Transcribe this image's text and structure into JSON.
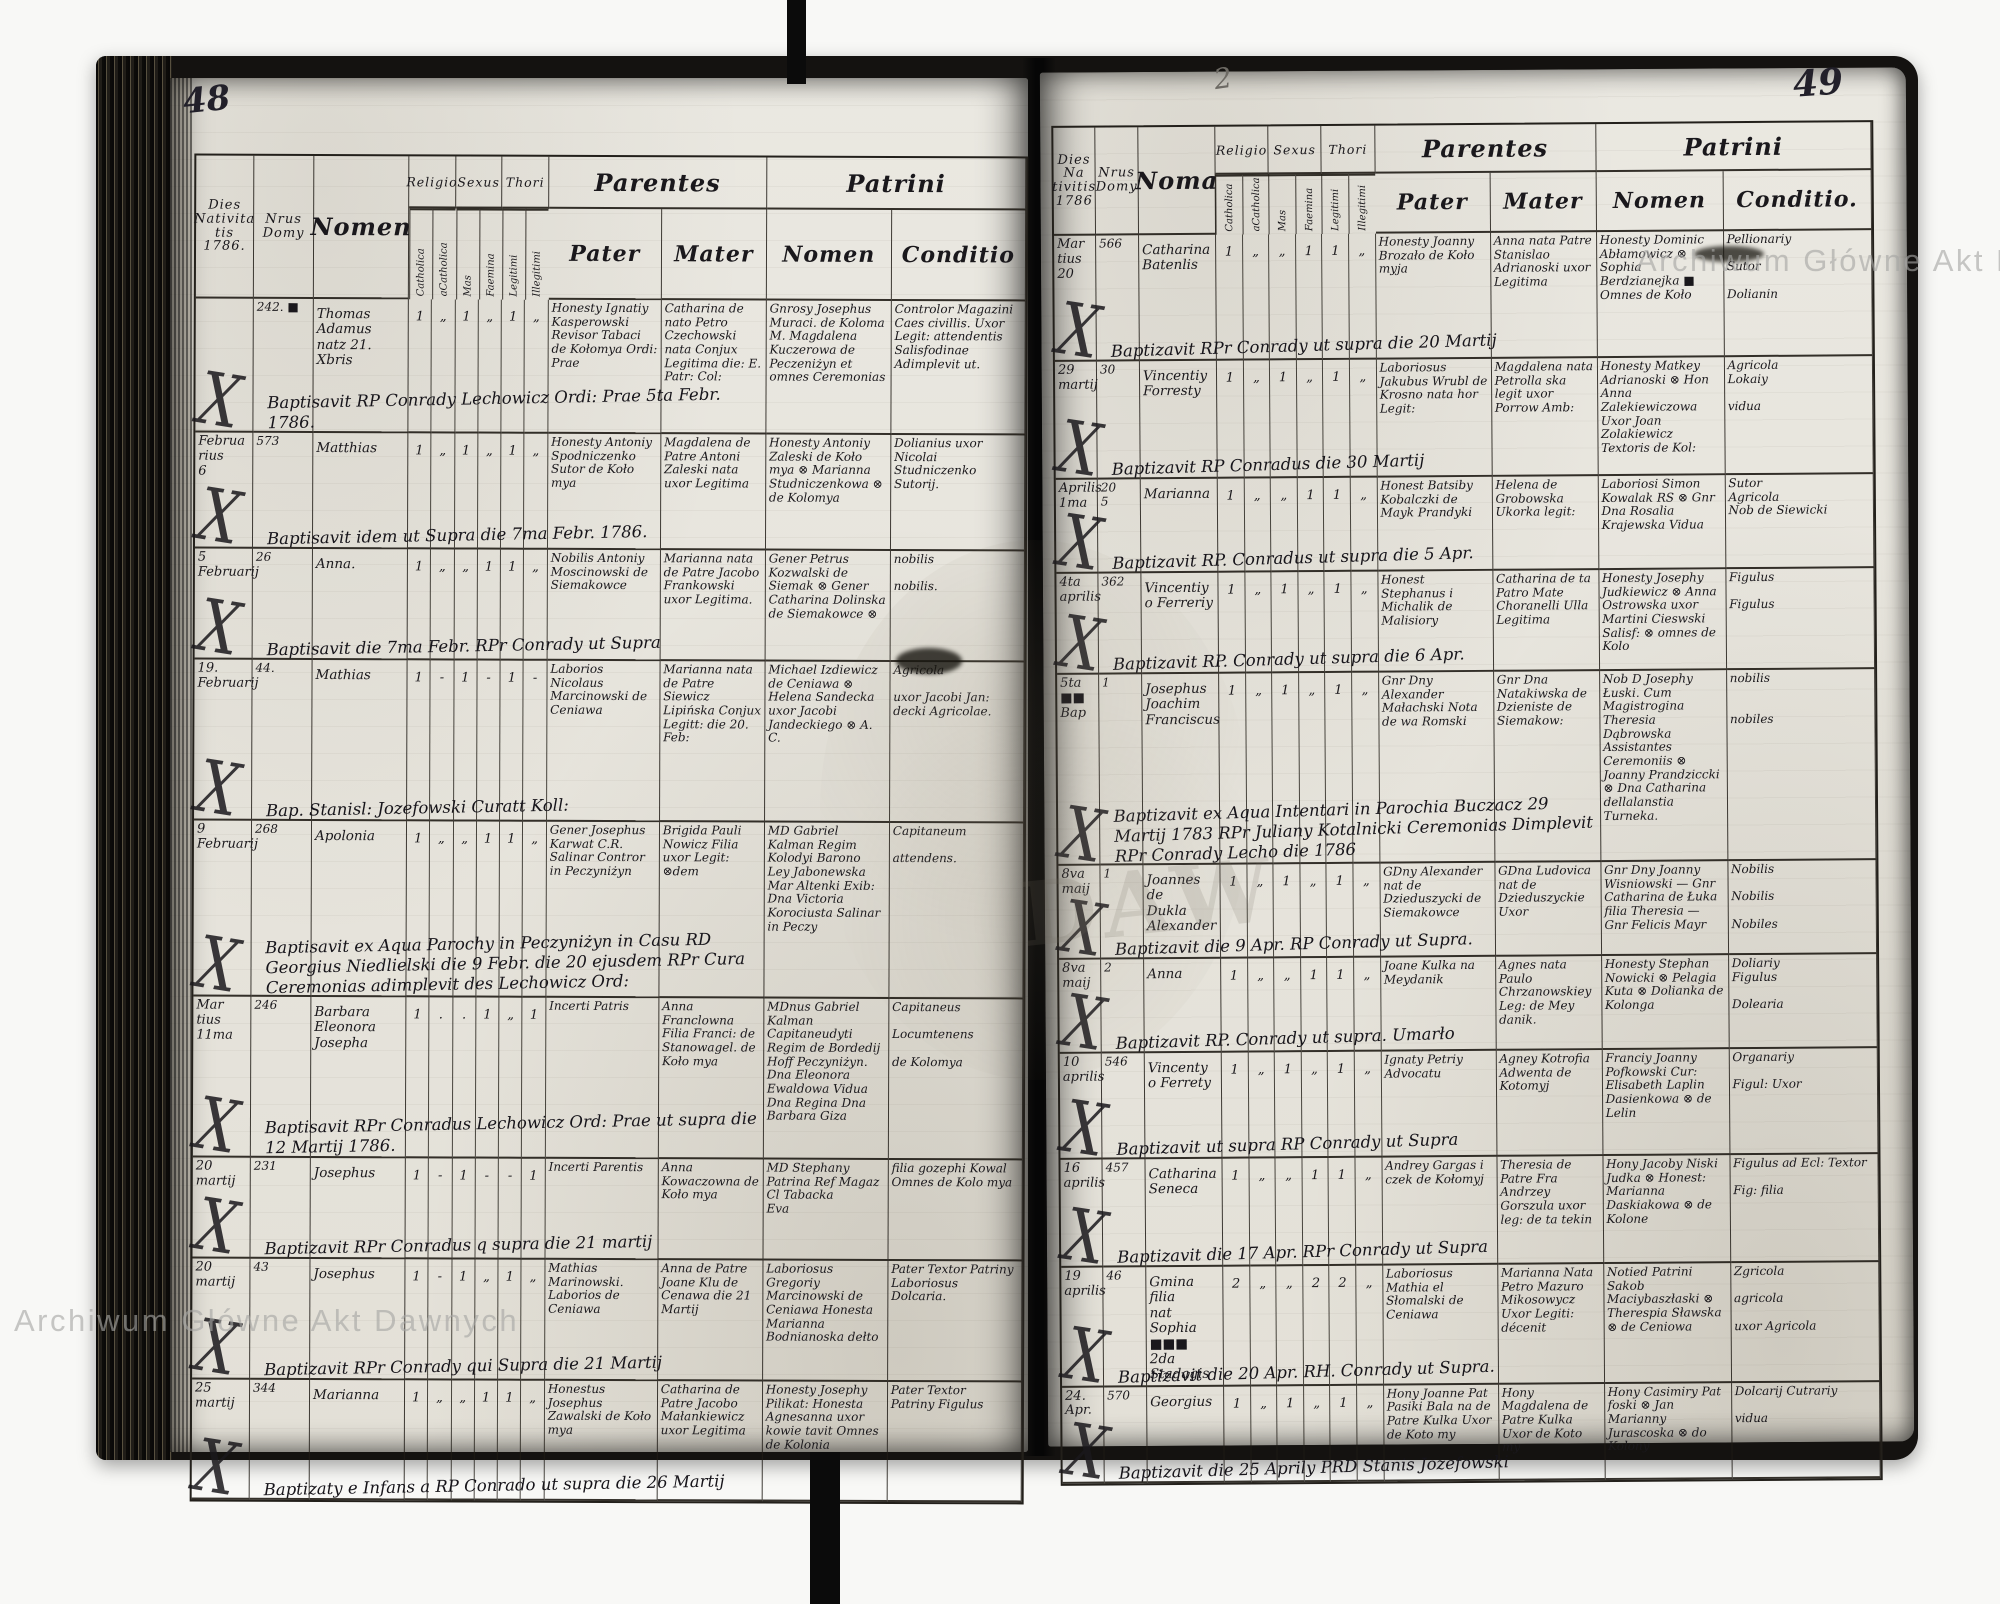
{
  "scan": {
    "page_left_number": "48",
    "page_right_number": "49",
    "corner_mark": "2",
    "watermark_top": "Archiwum Główne Akt Dawnych",
    "watermark_bottom": "Archiwum Główne Akt Dawnych",
    "ghost_letters": "DAW",
    "ink_color": "#1a181c",
    "paper_color": "#e8e6df"
  },
  "left_page": {
    "number": "48",
    "headers": {
      "dies": "Dies\nNativita\ntis\n1786.",
      "nrus": "Nrus\nDomy",
      "nomen": "Nomen",
      "religio": "Religio",
      "sexus": "Sexus",
      "thori": "Thori",
      "sub": [
        "Catholica",
        "aCatholica",
        "Mas",
        "Faemina",
        "Legitimi",
        "Illegitimi"
      ],
      "parentes": "Parentes",
      "patrini": "Patrini",
      "pater": "Pater",
      "mater": "Mater",
      "pnomen": "Nomen",
      "conditio": "Conditio"
    },
    "rows": [
      {
        "dies": "",
        "x": "X",
        "nrus": "242. ■",
        "nomen": "Thomas\nAdamus\nnatz 21. Xbris",
        "ticks": [
          "1",
          "„",
          "1",
          "„",
          "1",
          "„"
        ],
        "note": "Baptisavit RP Conrady Lechowicz Ordi: Prae 5ta Febr. 1786.",
        "pater": "Honesty Ignatiy Kasperowski Revisor Tabaci de Kołomya Ordi: Prae",
        "mater": "Catharina de nato Petro Czechowski nata Conjux Legitima die: E. Patr: Col:",
        "patrini": "Gnrosy Josephus Muraci. de Koloma M. Magdalena Kuczerowa de Peczeniżyn et omnes Ceremonias",
        "conditio": "Controlor Magazini Caes civillis. Uxor Legit: attendentis Salisfodinae Adimplevit ut."
      },
      {
        "dies": "Februa\nrius\n6",
        "x": "X",
        "nrus": "573",
        "nomen": "Matthias",
        "ticks": [
          "1",
          "„",
          "1",
          "„",
          "1",
          "„"
        ],
        "note": "Baptisavit idem ut Supra die 7ma Febr. 1786.",
        "pater": "Honesty Antoniy Spodniczenko Sutor de Koło mya",
        "mater": "Magdalena de Patre Antoni Zaleski nata uxor Legitima",
        "patrini": "Honesty Antoniy Zaleski de Koło mya ⊗ Marianna Studniczenkowa ⊗ de Kolomya",
        "conditio": "Dolianius uxor Nicolai Studniczenko Sutorij."
      },
      {
        "dies": "5\nFebruarij",
        "x": "X",
        "nrus": "26",
        "nomen": "Anna.",
        "ticks": [
          "1",
          "„",
          "„",
          "1",
          "1",
          "„"
        ],
        "note": "Baptisavit die 7ma Febr. RPr Conrady ut Supra",
        "pater": "Nobilis Antoniy Moscinowski de Siemakowce",
        "mater": "Marianna nata de Patre Jacobo Frankowski uxor Legitima.",
        "patrini": "Gener Petrus Kozwalski de Siemak ⊗ Gener Catharina Dolinska de Siemakowce ⊗",
        "conditio": "nobilis\n\nnobilis."
      },
      {
        "dies": "19.\nFebruarij",
        "x": "X",
        "nrus": "44.",
        "nomen": "Mathias",
        "ticks": [
          "1",
          "-",
          "1",
          "-",
          "1",
          "-"
        ],
        "note": "Bap. Stanisl: Jozefowski Curatt Koll:",
        "pater": "Laborios Nicolaus Marcinowski de Ceniawa",
        "mater": "Marianna nata de Patre Siewicz Lipińska Conjux Legitt: die 20. Feb:",
        "patrini": "Michael Izdiewicz de Ceniawa ⊗ Helena Sandecka uxor Jacobi Jandeckiego ⊗ A. C.",
        "conditio": "Agricola\n\nuxor Jacobi Jan: decki Agricolae."
      },
      {
        "dies": "9\nFebruarij",
        "x": "X",
        "nrus": "268",
        "nomen": "Apolonia",
        "ticks": [
          "1",
          "„",
          "„",
          "1",
          "1",
          "„"
        ],
        "note": "Baptisavit ex Aqua Parochy in Peczyniżyn in Casu RD Georgius Niedlielski die 9 Febr. die 20 ejusdem RPr Cura Ceremonias adimplevit des Lechowicz Ord:",
        "pater": "Gener Josephus Karwat C.R. Salinar Contror in Peczyniżyn",
        "mater": "Brigida Pauli Nowicz Filia uxor Legit: ⊗dem",
        "patrini": "MD Gabriel Kalman Regim Kolodyi Barono Ley Jabonewska Mar Altenki Exib: Dna Victoria Korociusta Salinar in Peczy",
        "conditio": "Capitaneum\n\nattendens."
      },
      {
        "dies": "Mar\ntius\n11ma",
        "x": "X",
        "nrus": "246",
        "nomen": "Barbara\nEleonora\nJosepha",
        "ticks": [
          "1",
          ".",
          ".",
          "1",
          "„",
          "1"
        ],
        "note": "Baptisavit RPr Conradus Lechowicz Ord: Prae ut supra die 12 Martij 1786.",
        "pater": "Incerti Patris",
        "mater": "Anna Franclowna Filia Franci: de Stanowagel. de Koło mya",
        "patrini": "MDnus Gabriel Kalman Capitaneudyti Regim de Bordedij Hoff Peczyniżyn. Dna Eleonora Ewaldowa Vidua Dna Regina Dna Barbara Giza",
        "conditio": "Capitaneus\n\nLocumtenens\n\nde Kolomya"
      },
      {
        "dies": "20\nmartij",
        "x": "X",
        "nrus": "231",
        "nomen": "Josephus",
        "ticks": [
          "1",
          "-",
          "1",
          "-",
          "-",
          "1"
        ],
        "note": "Baptizavit RPr Conradus q supra die 21 martij",
        "pater": "Incerti Parentis",
        "mater": "Anna Kowaczowna de Koło mya",
        "patrini": "MD Stephany Patrina Ref Magaz Cl Tabacka\nEva",
        "conditio": "filia gozephi Kowal\nOmnes de Kolo mya"
      },
      {
        "dies": "20\nmartij",
        "x": "X",
        "nrus": "43",
        "nomen": "Josephus",
        "ticks": [
          "1",
          "-",
          "1",
          "„",
          "1",
          "„"
        ],
        "note": "Baptizavit RPr Conrady qui Supra die 21 Martij",
        "pater": "Mathias Marinowski. Laborios de Ceniawa",
        "mater": "Anna de Patre Joane Klu de Cenawa die 21 Martij",
        "patrini": "Laboriosus Gregoriy Marcinowski de Ceniawa Honesta Marianna Bodnianoska dełto",
        "conditio": "Pater Textor Patriny Laboriosus\nDolcaria."
      },
      {
        "dies": "25\nmartij",
        "x": "X",
        "nrus": "344",
        "nomen": "Marianna",
        "ticks": [
          "1",
          "„",
          "„",
          "1",
          "1",
          "„"
        ],
        "note": "Baptizaty e Infans a RP Conrado ut supra die 26 Martij",
        "pater": "Honestus Josephus Zawalski de Koło mya",
        "mater": "Catharina de Patre Jacobo Małankiewicz uxor Legitima",
        "patrini": "Honesty Josephy Pilikat: Honesta Agnesanna uxor kowie tavit Omnes de Kolonia",
        "conditio": "Pater  Textor\nPatriny  Figulus"
      }
    ]
  },
  "right_page": {
    "number": "49",
    "headers": {
      "dies": "Dies Na\ntivitis\n1786",
      "nrus": "Nrus\nDomy",
      "nomen": "Noma",
      "religio": "Religio",
      "sexus": "Sexus",
      "thori": "Thori",
      "sub": [
        "Catholica",
        "aCatholica",
        "Mas",
        "Faemina",
        "Legitimi",
        "Illegitimi"
      ],
      "parentes": "Parentes",
      "patrini": "Patrini",
      "pater": "Pater",
      "mater": "Mater",
      "pnomen": "Nomen",
      "conditio": "Conditio."
    },
    "rows": [
      {
        "dies": "Mar\ntius\n20",
        "x": "X",
        "nrus": "566",
        "nomen": "Catharina\nBatenlis",
        "ticks": [
          "1",
          "„",
          "„",
          "1",
          "1",
          "„"
        ],
        "note": "Baptizavit RPr Conrady ut supra die 20 Martij",
        "pater": "Honesty Joanny Brozało de Koło myja",
        "mater": "Anna nata Patre Stanislao Adrianoski uxor Legitima",
        "patrini": "Honesty Dominic Abłamowicz ⊗ Sophia Berdzianejka ■ Omnes de Koło",
        "conditio": "Pellionariy\n\nSutor\n\nDolianin"
      },
      {
        "dies": "29\nmartij",
        "x": "X",
        "nrus": "30",
        "nomen": "Vincentiy\nForresty",
        "ticks": [
          "1",
          "„",
          "1",
          "„",
          "1",
          "„"
        ],
        "note": "Baptizavit RP Conradus die 30 Martij",
        "pater": "Laboriosus Jakubus Wrubl de Krosno nata hor Legit:",
        "mater": "Magdalena nata Petrolla ska legit uxor Porrow Amb:",
        "patrini": "Honesty Matkey Adrianoski ⊗ Hon Anna Zalekiewiczowa Uxor Joan Zolakiewicz Textoris de Kol:",
        "conditio": "Agricola\nLokaiy\n\nvidua"
      },
      {
        "dies": "Aprilis\n1ma",
        "x": "X",
        "nrus": "20\n5",
        "nomen": "Marianna",
        "ticks": [
          "1",
          "„",
          "„",
          "1",
          "1",
          "„"
        ],
        "note": "Baptizavit RP. Conradus ut supra die 5 Apr.",
        "pater": "Honest Batsiby Kobalczki de Mayk Prandyki",
        "mater": "Helena de Grobowska Ukorka legit:",
        "patrini": "Laboriosi Simon Kowalak RS ⊗ Gnr Dna Rosalia Krajewska Vidua",
        "conditio": "Sutor\nAgricola\nNob de Siewicki"
      },
      {
        "dies": "4ta\naprilis",
        "x": "X",
        "nrus": "362",
        "nomen": "Vincentiy\no Ferreriy",
        "ticks": [
          "1",
          "„",
          "1",
          "„",
          "1",
          "„"
        ],
        "note": "Baptizavit RP. Conrady ut supra die 6 Apr.",
        "pater": "Honest Stephanus i Michalik de Malisiory",
        "mater": "Catharina de ta Patro Mate Choranelli Ulla Legitima",
        "patrini": "Honesty Josephy Judkiewicz ⊗ Anna Ostrowska uxor Martini Cieswski Salisf: ⊗ omnes de Kolo",
        "conditio": "Figulus\n\nFigulus"
      },
      {
        "dies": "5ta ■■\nBap",
        "x": "X",
        "nrus": "1",
        "nomen": "Josephus\nJoachim\nFranciscus",
        "ticks": [
          "1",
          "„",
          "1",
          "„",
          "1",
          "„"
        ],
        "note": "Baptizavit ex Aqua Intentari in Parochia Buczacz 29 Martij 1783 RPr Juliany Kotalnicki Ceremonias Dimplevit RPr Conrady Lecho die 1786",
        "pater": "Gnr Dny Alexander Małachski Nota de wa Romski",
        "mater": "Gnr Dna Natakiwska de Dzieniste de Siemakow:",
        "patrini": "Nob D Josephy Łuski. Cum Magistrogina Theresia Dąbrowska Assistantes Ceremoniis ⊗ Joanny Prandziccki ⊗ Dna Catharina dellalanstia Turneka.",
        "conditio": "nobilis\n\n\nnobiles"
      },
      {
        "dies": "8va\nmaij",
        "x": "X",
        "nrus": "1",
        "nomen": "Joannes de\nDukla\nAlexander",
        "ticks": [
          "1",
          "„",
          "1",
          "„",
          "1",
          "„"
        ],
        "note": "Baptizavit die 9 Apr. RP Conrady ut Supra.",
        "pater": "GDny Alexander nat de Dzieduszycki de Siemakowce",
        "mater": "GDna Ludovica nat de Dzieduszyckie Uxor",
        "patrini": "Gnr Dny Joanny Wisniowski — Gnr Catharina de Łuka filia Theresia — Gnr Felicis Mayr",
        "conditio": "Nobilis\n\nNobilis\n\nNobiles"
      },
      {
        "dies": "8va\nmaij",
        "x": "X",
        "nrus": "2",
        "nomen": "Anna",
        "ticks": [
          "1",
          "„",
          "„",
          "1",
          "1",
          "„"
        ],
        "note": "Baptizavit RP. Conrady ut supra.  Umarło",
        "pater": "Joane Kulka na Meydanik",
        "mater": "Agnes nata Paulo Chrzanowskiey Leg: de Mey danik.",
        "patrini": "Honesty Stephan Nowicki ⊗ Pelagia Kuta ⊗ Dolianka de Kolonga",
        "conditio": "Doliariy\nFigulus\n\nDolearia"
      },
      {
        "dies": "10\naprilis",
        "x": "X",
        "nrus": "546",
        "nomen": "Vincenty\no Ferrety",
        "ticks": [
          "1",
          "„",
          "1",
          "„",
          "1",
          "„"
        ],
        "note": "Baptizavit ut supra RP Conrady ut Supra",
        "pater": "Ignaty Petriy Advocatu",
        "mater": "Agney Kotrofia Adwenta de Kotomyj",
        "patrini": "Franciy Joanny Pofkowski Cur: Elisabeth Laplin Dasienkowa ⊗ de Lelin",
        "conditio": "Organariy\n\nFigul: Uxor"
      },
      {
        "dies": "16\naprilis",
        "x": "X",
        "nrus": "457",
        "nomen": "Catharina\nSeneca",
        "ticks": [
          "1",
          "„",
          "„",
          "1",
          "1",
          "„"
        ],
        "note": "Baptizavit die 17 Apr. RPr Conrady ut Supra",
        "pater": "Andrey Gargas i czek de Kołomyj",
        "mater": "Theresia de Patre Fra Andrzey Gorszula uxor leg: de ta tekin",
        "patrini": "Hony Jacoby Niski Judka ⊗ Honest: Marianna Daskiakowa ⊗ de Kolone",
        "conditio": "Figulus ad Ecl: Textor\n\nFig: filia"
      },
      {
        "dies": "19\naprilis",
        "x": "X",
        "nrus": "46",
        "nomen": "Gmina filia\nnat Sophia\n■■■\n2da Stadagis",
        "ticks": [
          "2",
          "„",
          "„",
          "2",
          "2",
          "„"
        ],
        "note": "Baptizavit die 20 Apr. RH. Conrady ut Supra.",
        "pater": "Laboriosus Mathia el Słomalski de Ceniawa",
        "mater": "Marianna Nata Petro Mazuro Mikosowycz Uxor Legiti: décenit",
        "patrini": "Notied Patrini Sakob Maciybaszłaski ⊗ Therespia Sławska ⊗ de Ceniowa",
        "conditio": "Zgricola\n\nagricola\n\nuxor Agricola"
      },
      {
        "dies": "24.\nApr.",
        "x": "X",
        "nrus": "570",
        "nomen": "Georgius",
        "ticks": [
          "1",
          "„",
          "1",
          "„",
          "1",
          "„"
        ],
        "note": "Baptizavit die 25 Aprily PRD Stanis Jozefowski",
        "pater": "Hony Joanne Pat Pasiki Bala na de Patre Kulka Uxor de Koto my",
        "mater": "Hony Magdalena de Patre Kulka Uxor de Koto my",
        "patrini": "Hony Casimiry Pat foski ⊗ Jan Marianny Jurascoska ⊗ do Kolony",
        "conditio": "Dolcarij Cutrariy\n\nvidua"
      }
    ]
  }
}
